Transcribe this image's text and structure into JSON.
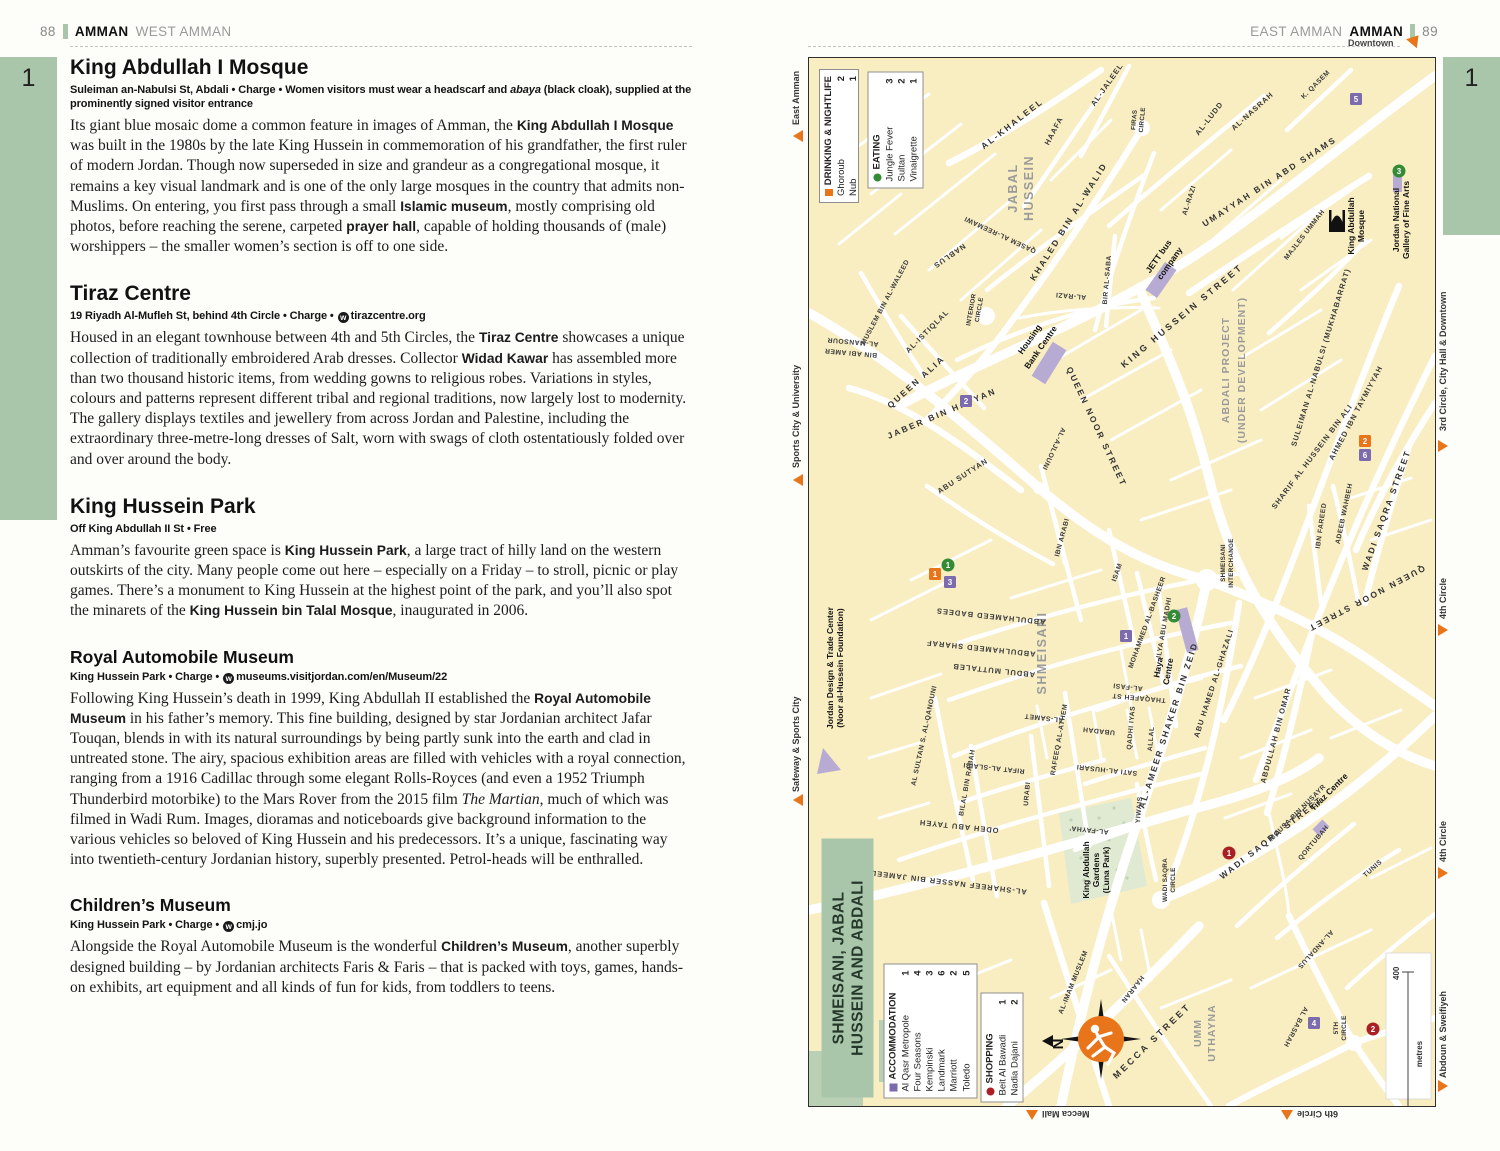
{
  "shared": {
    "web_icon_letter": "w"
  },
  "left_page": {
    "page_number": "88",
    "section": "AMMAN",
    "subsection": "WEST AMMAN",
    "tab_number": "1",
    "articles": [
      {
        "heading": "King Abdullah I Mosque",
        "info": [
          "Suleiman an-Nabulsi St, Abdali • Charge • Women visitors must wear a headscarf and ",
          "abaya",
          " (black cloak), supplied at the prominently signed visitor entrance"
        ],
        "body": [
          "Its giant blue mosaic dome a common feature in images of Amman, the ",
          "King Abdullah I Mosque",
          " was built in the 1980s by the late King Hussein in commemoration of his grandfather, the first ruler of modern Jordan. Though now superseded in size and grandeur as a congregational mosque, it remains a key visual landmark and is one of the only large mosques in the country that admits non-Muslims. On entering, you first pass through a small ",
          "Islamic museum",
          ", mostly comprising old photos, before reaching the serene, carpeted ",
          "prayer hall",
          ", capable of holding thousands of (male) worshippers – the smaller women’s section is off to one side."
        ]
      },
      {
        "heading": "Tiraz Centre",
        "info": [
          "19 Riyadh Al-Mufleh St, behind 4th Circle • Charge • ",
          "tirazcentre.org"
        ],
        "body": [
          "Housed in an elegant townhouse between 4th and 5th Circles, the ",
          "Tiraz Centre",
          " showcases a unique collection of traditionally embroidered Arab dresses. Collector ",
          "Widad Kawar",
          " has assembled more than two thousand historic items, from wedding gowns to religious robes. Variations in styles, colours and patterns represent different tribal and regional traditions, now largely lost to modernity. The gallery displays textiles and jewellery from across Jordan and Palestine, including the extraordinary three-metre-long dresses of Salt, worn with swags of cloth ostentatiously folded over and over around the body."
        ]
      },
      {
        "heading": "King Hussein Park",
        "info": [
          "Off King Abdullah II St • Free"
        ],
        "body": [
          "Amman’s favourite green space is ",
          "King Hussein Park",
          ", a large tract of hilly land on the western outskirts of the city. Many people come out here – especially on a Friday – to stroll, picnic or play games. There’s a monument to King Hussein at the highest point of the park, and you’ll also spot the minarets of the ",
          "King Hussein bin Talal Mosque",
          ", inaugurated in 2006."
        ]
      },
      {
        "heading": "Royal Automobile Museum",
        "info": [
          "King Hussein Park • Charge • ",
          "museums.visitjordan.com/en/Museum/22"
        ],
        "body": [
          "Following King Hussein’s death in 1999, King Abdullah II established the ",
          "Royal Automobile Museum",
          " in his father’s memory. This fine building, designed by star Jordanian architect Jafar Touqan, blends in with its natural surroundings by being partly sunk into the earth and clad in untreated stone. The airy, spacious exhibition areas are filled with vehicles with a royal connection, ranging from a 1916 Cadillac through some elegant Rolls-Royces (and even a 1952 Triumph Thunderbird motorbike) to the Mars Rover from the 2015 film ",
          "The Martian",
          ", much of which was filmed in Wadi Rum. Images, dioramas and noticeboards give background information to the various vehicles so beloved of King Hussein and his predecessors. It’s a unique, fascinating way into twentieth-century Jordanian history, superbly presented. Petrol-heads will be enthralled."
        ]
      },
      {
        "heading": "Children’s Museum",
        "info": [
          "King Hussein Park • Charge • ",
          "cmj.jo"
        ],
        "body": [
          "Alongside the Royal Automobile Museum is the wonderful ",
          "Children’s Museum",
          ", another superbly designed building – by Jordanian architects Faris & Faris – that is packed with toys, games, hands-on exhibits, art equipment and all kinds of fun for kids, from toddlers to teens."
        ]
      }
    ]
  },
  "right_page": {
    "page_number": "89",
    "section_light": "EAST AMMAN",
    "section_bold": "AMMAN",
    "tab_number": "1"
  },
  "map": {
    "title": [
      "SHMEISANI, JABAL",
      "HUSSEIN AND ABDALI"
    ],
    "legend_drinking": {
      "title": "DRINKING & NIGHTLIFE",
      "items": [
        [
          "Ghoroub",
          "2"
        ],
        [
          "Nub",
          "1"
        ]
      ]
    },
    "legend_eating": {
      "title": "EATING",
      "items": [
        [
          "Jungle Fever",
          "3"
        ],
        [
          "Sultan",
          "2"
        ],
        [
          "Vinaigrette",
          "1"
        ]
      ]
    },
    "legend_accommodation": {
      "title": "ACCOMMODATION",
      "items": [
        [
          "Al Qasr Metropole",
          "1"
        ],
        [
          "Four Seasons",
          "4"
        ],
        [
          "Kempinski",
          "3"
        ],
        [
          "Landmark",
          "6"
        ],
        [
          "Marriott",
          "2"
        ],
        [
          "Toledo",
          "5"
        ]
      ]
    },
    "legend_shopping": {
      "title": "SHOPPING",
      "items": [
        [
          "Beit Al Bawadi",
          "1"
        ],
        [
          "Nadia Dajani",
          "2"
        ]
      ]
    },
    "edges": {
      "downtown": "Downtown",
      "east_amman": "East Amman",
      "sports": "Sports City & University",
      "safeway": "Safeway & Sports City",
      "third_circle": "3rd Circle, City Hall & Downtown",
      "fourth_circle_a": "4th Circle",
      "fourth_circle_b": "4th Circle",
      "abdoun": "Abdoun & Sweifiyeh",
      "mecca_mall": "Mecca Mall",
      "sixth_circle": "6th Circle"
    },
    "districts": {
      "jabal": [
        "JABAL",
        "HUSSEIN"
      ],
      "shmeisani": "SHMEISANI",
      "umm": [
        "UMM",
        "UTHAYNA"
      ],
      "abdali": [
        "ABDALI PROJECT",
        "(UNDER DEVELOPMENT)"
      ]
    },
    "circles": {
      "firas": [
        "FIRAS",
        "CIRCLE"
      ],
      "interior": [
        "INTERIOR",
        "CIRCLE"
      ],
      "shm_int": [
        "SHMEISANI",
        "INTERCHANGE"
      ],
      "ws_circle": [
        "WADI SAQRA",
        "CIRCLE"
      ],
      "fifth": [
        "5TH",
        "CIRCLE"
      ]
    },
    "places": {
      "jett": [
        "JETT bus",
        "company"
      ],
      "housing": [
        "Housing",
        "Bank Centre"
      ],
      "mosque": [
        "King Abdullah",
        "Mosque"
      ],
      "gallery": [
        "Jordan National",
        "Gallery of Fine Arts"
      ],
      "haya": [
        "Haya",
        "Centre"
      ],
      "tiraz": "Tiraz Centre",
      "gardens": [
        "King Abdullah",
        "Gardens",
        "(Luna Park)"
      ],
      "jdtc": [
        "Jordan Design & Trade Center",
        "(Noor al-Hussein Foundation)"
      ]
    },
    "streets": {
      "khaleel": "AL-KHALEEL",
      "haafa": "HAAFA",
      "jaleel": "AL-JALEEL",
      "nasrah": "AL-NASRAH",
      "kqasem": "K. QASEM",
      "ludd": "AL-LUDD",
      "khaled": "KHALED BIN AL-WALID",
      "reemawi": "QASEM AL-REEMAWI",
      "nablus": "NABLUS",
      "istiqlal": "AL-ISTIQLAL",
      "muslem_waleed": "MUSLEM BIN AL-WALEED",
      "bir": "BIR AL-SABA",
      "razi": "AL-RAZI",
      "umayyah": "UMAYYAH BIN ABD SHAMS",
      "king_hussein": "KING HUSSEIN STREET",
      "majles": "MAJLES UMMAH",
      "suleiman": "SULEIMAN AL-NABULSI (MUKHABARRAT)",
      "ahmed": "AHMED IBN TAYMIYYAH",
      "sharif": "SHARIF AL HUSSEIN BIN ALI",
      "adeeb": "ADEEB WAHBEH",
      "ibn_fareed": "IBN FAREED",
      "wadi": "WADI SAQRA STREET",
      "qnoor": "QUEEN NOOR STREET",
      "qalia": "QUEEN ALIA",
      "jaber": "JABER BIN HAYYAN",
      "abu_sutyan": "ABU SUTYAN",
      "mansour_a": "AL-MANSOUR",
      "mansour_b": "BIN ABI AMER",
      "ajlouni": "AL-AJLOUNI",
      "ibn_arabi": "IBN ARABI",
      "isam": "ISAM",
      "basheer": "MOHAMMED AL-BASHEER",
      "thaqafeh": "THAQAFEH ST",
      "ilya": "ILYA ABU MADHI",
      "badees": "ABDULHAMEED BADEES",
      "sharaf": "ABDULHAMEED SHARAF",
      "muttaleb": "ABDUL MUTTALEB",
      "qanouni": "AL SULTAN S. AL-QANOUNI",
      "rifat": "RIFAT AL-SLAIBI",
      "bilal": "BILAL BIN RABAH",
      "urabi": "URABI",
      "rafeeq": "RAFEEQ AL-ATHEM",
      "samet": "AL-SAMET",
      "fasi": "AL-FASI",
      "qadhi": "QADHI IYAS",
      "allal": "ALLAL",
      "sati": "SATI AL-HUSARI",
      "yiwais": "YIWAIS",
      "ubadah": "UBADAH",
      "fayha": "AL-FAYHA’",
      "odeh": "ODEH ABU TAYEH",
      "ameer": "AL-AMEER SHAKER BIN ZEID",
      "ghazali": "ABU HAMED AL-GHAZALI",
      "abdullah_omar": "ABDULLAH BIN OMAR",
      "mousa": "MOUSA BIN NUSAYR",
      "qortubah": "QORTUBAH",
      "tunis": "TUNIS",
      "andalus": "AL-ANDALUS",
      "basrah": "AL BASRAH",
      "imam": "AL-IMAM MUSLEM",
      "haaran": "HAARAN",
      "mecca": "MECCA STREET",
      "nasser": "AL-SHAREEF NASSER BIN JAMEEL"
    },
    "markers": {
      "p5": "5",
      "g3": "3",
      "p2": "2",
      "o1": "1",
      "g1": "1",
      "p3": "3",
      "p1": "1",
      "g2": "2",
      "o2": "2",
      "p6": "6",
      "r1": "1",
      "p4": "4",
      "r2": "2"
    },
    "scale": {
      "max": "400",
      "min": "0",
      "unit": "metres"
    },
    "compass": {
      "n": "N"
    },
    "colors": {
      "accent_orange": "#e8751a",
      "sage_green": "#a9c6ab",
      "accommodation_purple": "#7c6bad",
      "eating_green": "#358a35",
      "shopping_red": "#aa1f23",
      "map_cream": "#f9edc2",
      "building_lavender": "#b7abd3"
    }
  }
}
